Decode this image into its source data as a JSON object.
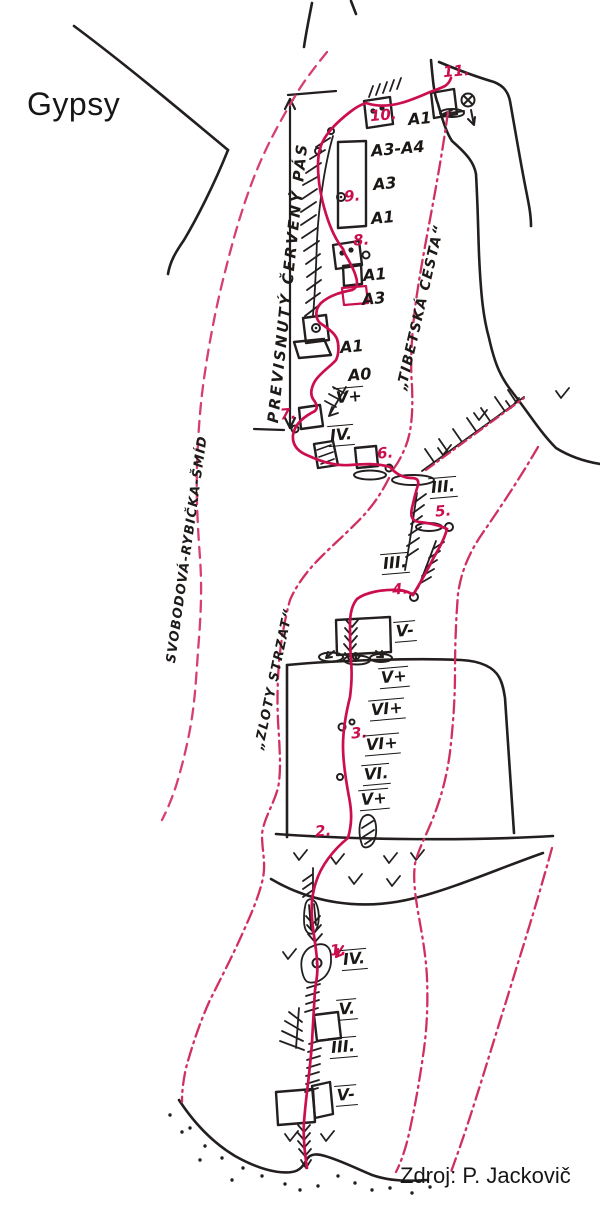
{
  "title": "Gypsy",
  "source_credit": "Zdroj: P. Jackovič",
  "colors": {
    "route_solid": "#cb0e4e",
    "route_dashed": "#d6406f",
    "route_dashdot": "#d03060",
    "pitch_label": "#c9104c",
    "ink": "#241f1f",
    "paper": "#ffffff"
  },
  "route_names": [
    {
      "id": "previsnuty-cerveny-pas",
      "text": "PREVISNUTÝ ČERVENÝ PÁS",
      "x": 264,
      "y": 422,
      "rot": -84,
      "size": 15,
      "ls": 2.5
    },
    {
      "id": "tibetska-cesta",
      "text": "„TIBETSKÁ CESTA“",
      "x": 394,
      "y": 388,
      "rot": -77,
      "size": 14,
      "ls": 1.5
    },
    {
      "id": "svobodova-rybicka-smid",
      "text": "SVOBODOVÁ-RYBIČKA-ŠMÍD",
      "x": 164,
      "y": 662,
      "rot": -82,
      "size": 13,
      "ls": 1.2
    },
    {
      "id": "zloty-strzat",
      "text": "„ZLOTY STRZAT“",
      "x": 252,
      "y": 748,
      "rot": -78,
      "size": 13,
      "ls": 1.5
    }
  ],
  "pitches": [
    {
      "label": "1.",
      "x": 330,
      "y": 941
    },
    {
      "label": "2.",
      "x": 315,
      "y": 822
    },
    {
      "label": "3.",
      "x": 351,
      "y": 724
    },
    {
      "label": "4.",
      "x": 392,
      "y": 580
    },
    {
      "label": "5.",
      "x": 435,
      "y": 502
    },
    {
      "label": "6.",
      "x": 377,
      "y": 444
    },
    {
      "label": "7.",
      "x": 280,
      "y": 405
    },
    {
      "label": "8.",
      "x": 353,
      "y": 231
    },
    {
      "label": "9.",
      "x": 344,
      "y": 187
    },
    {
      "label": "10.",
      "x": 370,
      "y": 106
    },
    {
      "label": "11.",
      "x": 443,
      "y": 62
    }
  ],
  "grades": [
    {
      "text": "A1",
      "x": 406,
      "y": 110,
      "over": false,
      "under": false
    },
    {
      "text": "A3-A4",
      "x": 369,
      "y": 140,
      "over": false,
      "under": false
    },
    {
      "text": "A3",
      "x": 371,
      "y": 175,
      "over": false,
      "under": false
    },
    {
      "text": "A1",
      "x": 369,
      "y": 209,
      "over": false,
      "under": false
    },
    {
      "text": "A1",
      "x": 361,
      "y": 266,
      "over": false,
      "under": false
    },
    {
      "text": "A3",
      "x": 360,
      "y": 290,
      "over": false,
      "under": false
    },
    {
      "text": "A1",
      "x": 338,
      "y": 338,
      "over": false,
      "under": false
    },
    {
      "text": "A0",
      "x": 346,
      "y": 366,
      "over": false,
      "under": false
    },
    {
      "text": "V+",
      "x": 334,
      "y": 387,
      "over": true,
      "under": false
    },
    {
      "text": "IV.",
      "x": 328,
      "y": 425,
      "over": true,
      "under": true
    },
    {
      "text": "III.",
      "x": 429,
      "y": 477,
      "over": true,
      "under": true
    },
    {
      "text": "III.",
      "x": 381,
      "y": 553,
      "over": true,
      "under": true
    },
    {
      "text": "V-",
      "x": 394,
      "y": 621,
      "over": true,
      "under": true
    },
    {
      "text": "V+",
      "x": 379,
      "y": 667,
      "over": true,
      "under": true
    },
    {
      "text": "VI+",
      "x": 369,
      "y": 699,
      "over": true,
      "under": true
    },
    {
      "text": "VI+",
      "x": 364,
      "y": 734,
      "over": true,
      "under": true
    },
    {
      "text": "VI.",
      "x": 362,
      "y": 764,
      "over": true,
      "under": true
    },
    {
      "text": "V+",
      "x": 359,
      "y": 789,
      "over": true,
      "under": true
    },
    {
      "text": "IV.",
      "x": 341,
      "y": 949,
      "over": true,
      "under": true
    },
    {
      "text": "V.",
      "x": 337,
      "y": 999,
      "over": true,
      "under": true
    },
    {
      "text": "III.",
      "x": 329,
      "y": 1037,
      "over": true,
      "under": true
    },
    {
      "text": "V-",
      "x": 335,
      "y": 1085,
      "over": true,
      "under": true
    }
  ]
}
